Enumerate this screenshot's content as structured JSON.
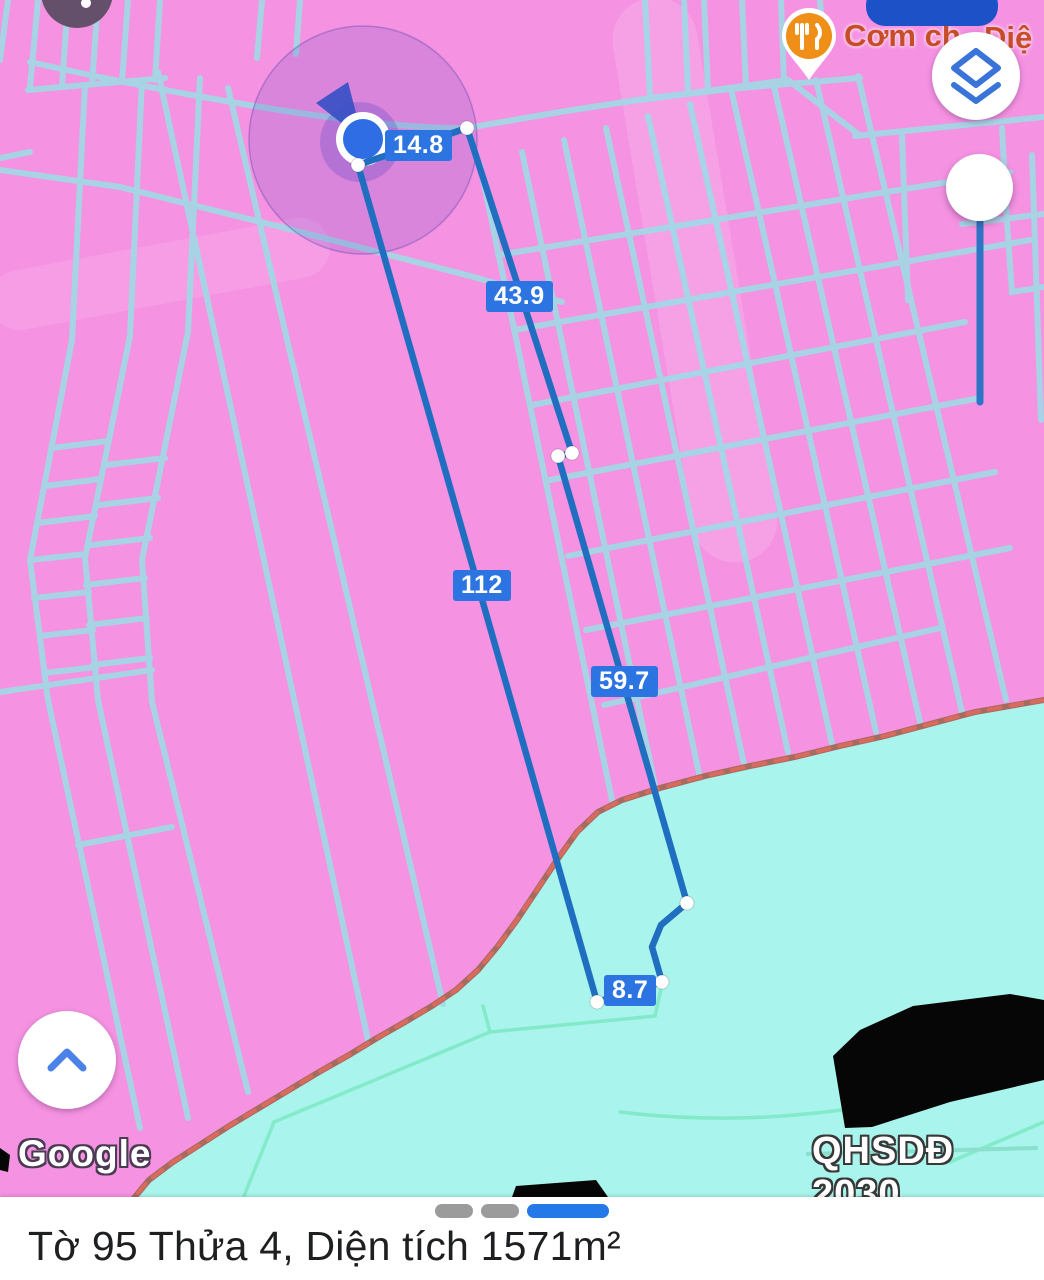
{
  "app": "google-maps-measure-view",
  "map": {
    "poi": {
      "icon": "restaurant-icon",
      "label_left": "Cơm ch",
      "label_right": "Diệ"
    },
    "watermark": "Google",
    "plan_overlay_label": "QHSDĐ 2030",
    "zones": {
      "land_color": "#f592e2",
      "water_color": "#a9f4ec",
      "parcel_line_color": "#a3d7e6",
      "boundary_color": "#b66a56"
    }
  },
  "measurements": {
    "unit": "m",
    "values": [
      "14.8",
      "43.9",
      "112",
      "59.7",
      "8.7"
    ],
    "line_color": "#1f6ec0",
    "label_bg": "#2b74e2"
  },
  "controls": {
    "layers_button_icon": "layers-icon",
    "marker_pin_icon": "pin-marker",
    "locate_button_icon": "chevron-up-icon",
    "location_puck_icon": "my-location-puck",
    "top_pill_color": "#1c51c8"
  },
  "bottom_sheet": {
    "title": "Tờ 95 Thửa 4, Diện tích 1571m²",
    "page_dots": [
      "inactive",
      "inactive",
      "active"
    ]
  }
}
